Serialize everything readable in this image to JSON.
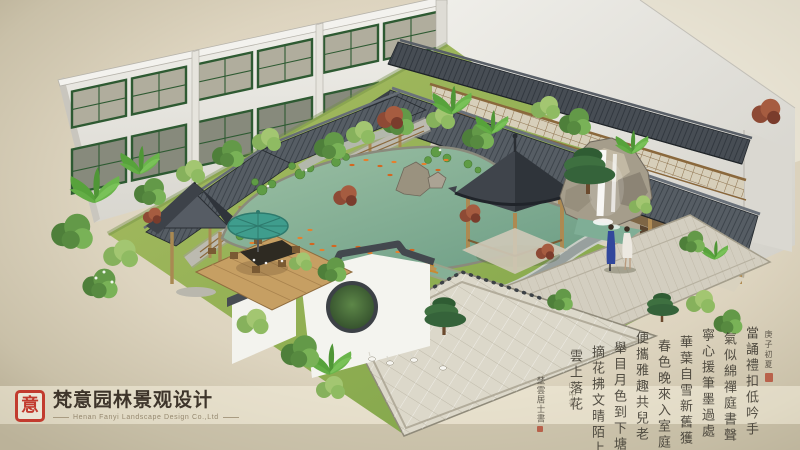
{
  "branding": {
    "seal_character": "意",
    "company_name_zh": "梵意园林景观设计",
    "company_name_en": "Henan Fanyi Landscape Design Co.,Ltd"
  },
  "calligraphy": {
    "note": "cursive grass-script poem panel, transcription approximate",
    "header": "庚子初夏",
    "columns": [
      "當誦禮扣低吟手",
      "氣似綿禪庭書聲",
      "寧心援筆墨過處",
      "華葉自雪新舊獲",
      "春色晚來入室庭",
      "便攜雅趣共兒老",
      "舉目月色到下塘",
      "摘花拂文晴陌上",
      "雲上落花"
    ],
    "signature": "埜雲居士書",
    "signature_secondary": "山中書"
  },
  "palette": {
    "background_beige": "#d5cdb7",
    "accent_seal_red": "#c23b2e",
    "roof_slate": "#4a5056",
    "wood_tan": "#b08c54",
    "water_teal": "#7fae96",
    "lawn_green": "#8fae52",
    "wall_white": "#efeee9",
    "window_frame_green": "#2e5a32",
    "koi_orange": "#d96a2a",
    "umbrella_teal": "#3f9d8d",
    "ink": "#3e3a31"
  }
}
